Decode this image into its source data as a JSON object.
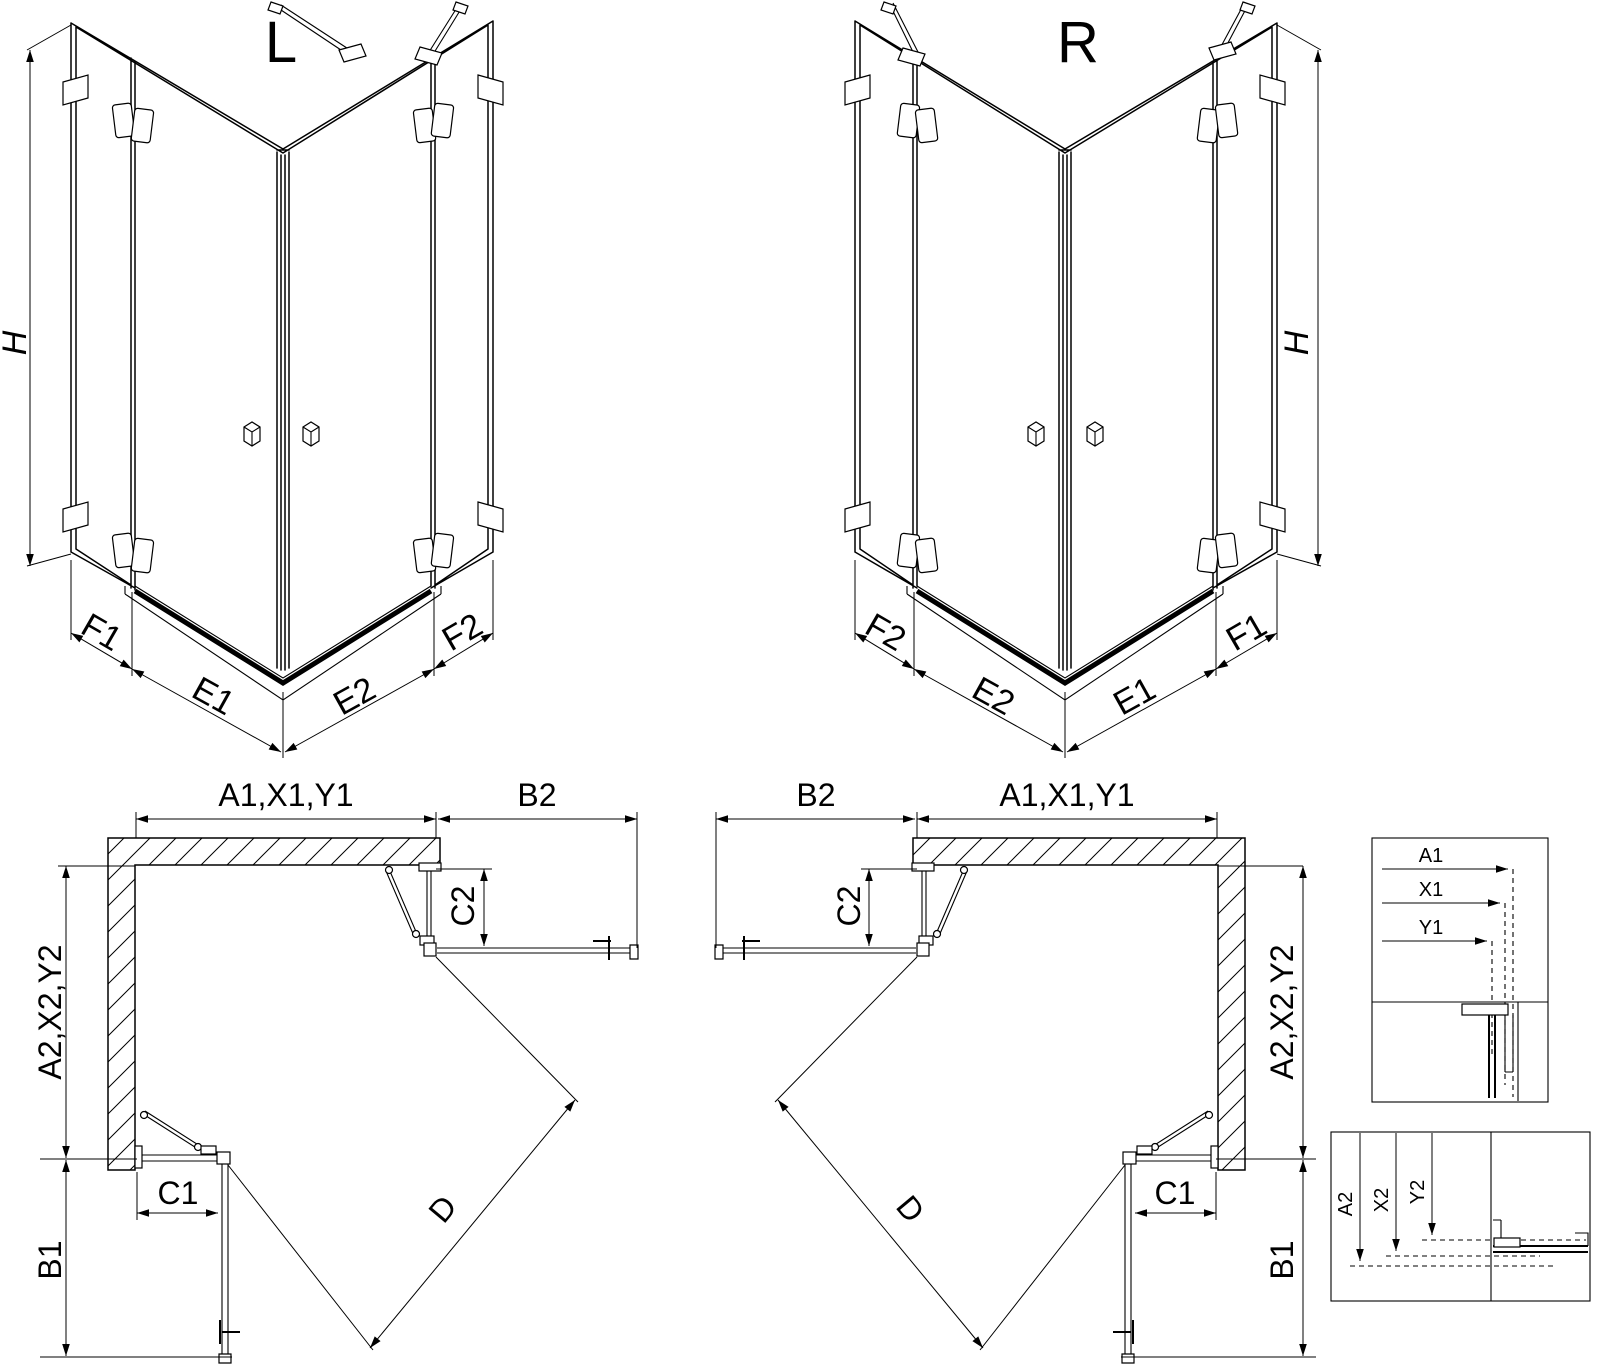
{
  "colors": {
    "line": "#000000",
    "background": "#ffffff"
  },
  "drawing": {
    "iso_left": {
      "title": "L",
      "height_dim": "H",
      "base_dims": [
        "F1",
        "E1",
        "E2",
        "F2"
      ]
    },
    "iso_right": {
      "title": "R",
      "height_dim": "H",
      "base_dims": [
        "F2",
        "E2",
        "E1",
        "F1"
      ]
    },
    "plan_left": {
      "top_width": "A1,X1,Y1",
      "top_right_width": "B2",
      "right_door_depth": "C2",
      "left_height": "A2,X2,Y2",
      "bottom_door_width": "C1",
      "bottom_height": "B1",
      "diagonal": "D"
    },
    "plan_right": {
      "top_left_width": "B2",
      "top_width": "A1,X1,Y1",
      "left_door_depth": "C2",
      "right_height": "A2,X2,Y2",
      "bottom_door_width": "C1",
      "bottom_height": "B1",
      "diagonal": "D"
    },
    "detail_top": {
      "dims": [
        "A1",
        "X1",
        "Y1"
      ]
    },
    "detail_bottom": {
      "dims": [
        "A2",
        "X2",
        "Y2"
      ]
    }
  }
}
